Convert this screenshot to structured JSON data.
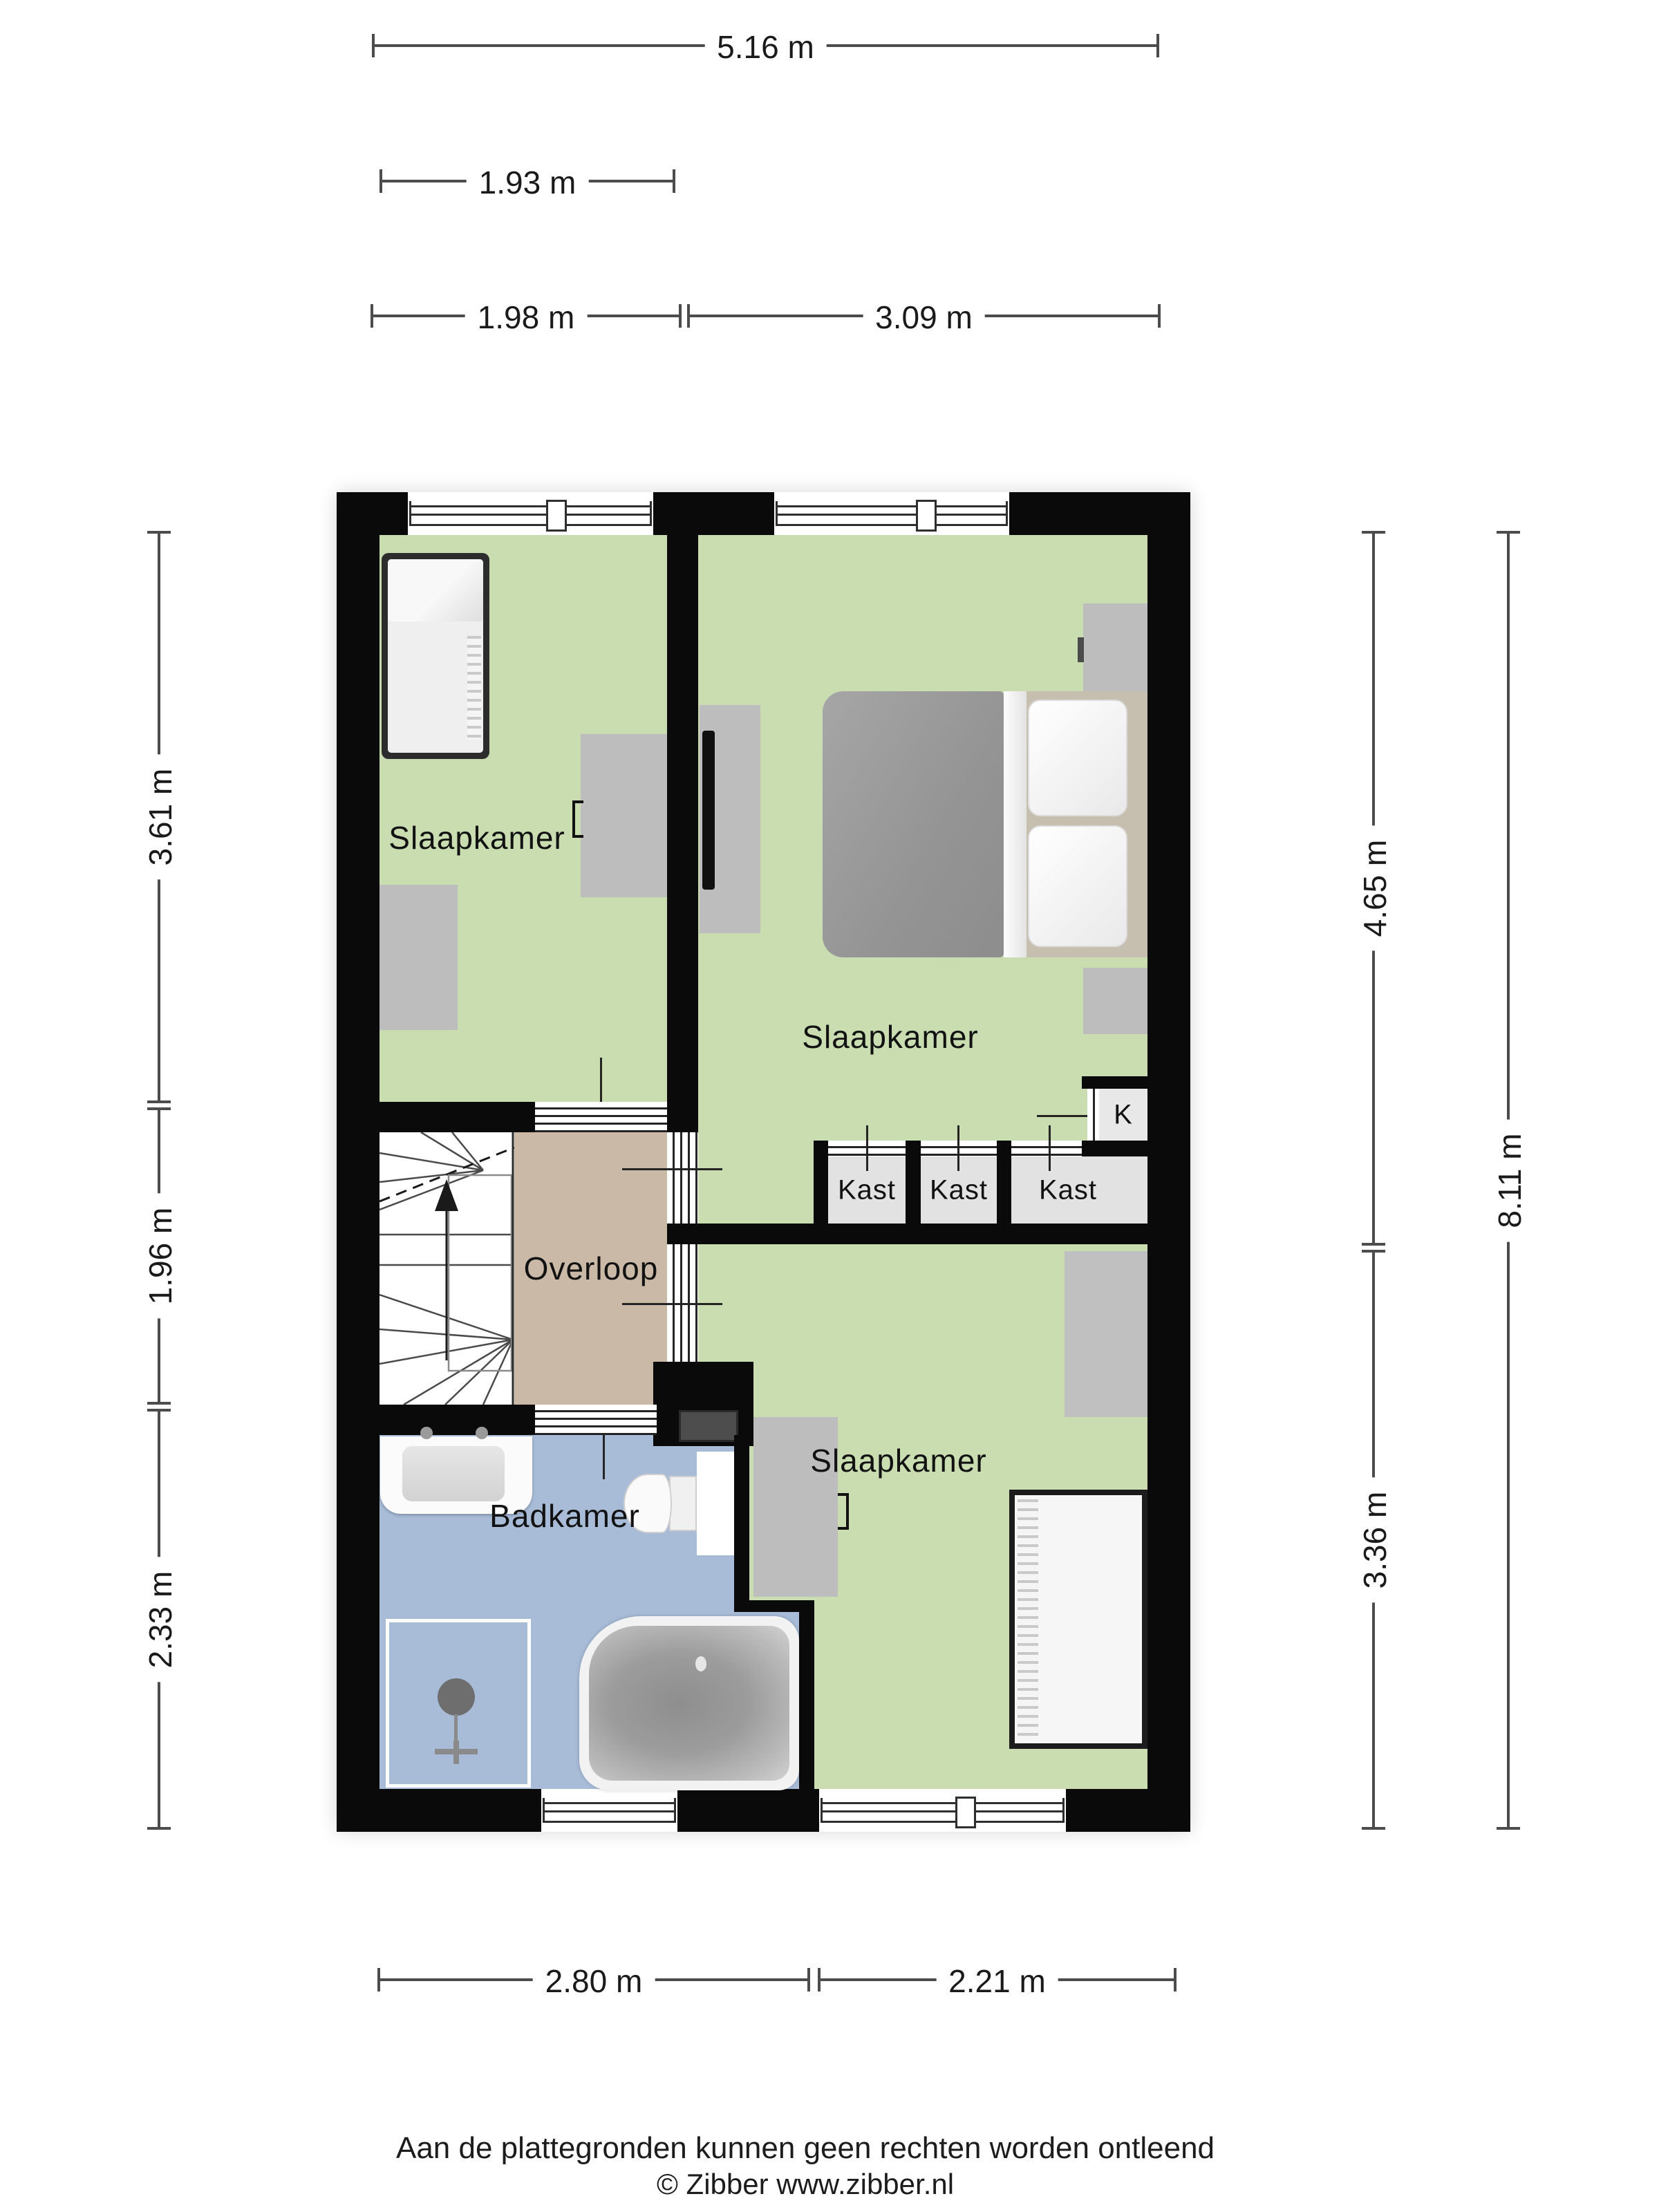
{
  "floorplan": {
    "rooms": [
      {
        "name": "slaapkamer-left",
        "label": "Slaapkamer"
      },
      {
        "name": "slaapkamer-right",
        "label": "Slaapkamer"
      },
      {
        "name": "slaapkamer-bottom",
        "label": "Slaapkamer"
      },
      {
        "name": "overloop",
        "label": "Overloop"
      },
      {
        "name": "badkamer",
        "label": "Badkamer"
      },
      {
        "name": "kast-1",
        "label": "Kast"
      },
      {
        "name": "kast-2",
        "label": "Kast"
      },
      {
        "name": "kast-3",
        "label": "Kast"
      },
      {
        "name": "k-closet",
        "label": "K"
      }
    ],
    "dimensions": {
      "top": [
        {
          "label": "5.16 m"
        },
        {
          "label": "1.93 m"
        },
        {
          "label": "1.98 m"
        },
        {
          "label": "3.09 m"
        }
      ],
      "left": [
        {
          "label": "3.61 m"
        },
        {
          "label": "1.96 m"
        },
        {
          "label": "2.33 m"
        }
      ],
      "right": [
        {
          "label": "4.65 m"
        },
        {
          "label": "3.36 m"
        },
        {
          "label": "8.11 m"
        }
      ],
      "bottom": [
        {
          "label": "2.80 m"
        },
        {
          "label": "2.21 m"
        }
      ]
    },
    "colors": {
      "room_green": "#c9ddb1",
      "hall_tan": "#c9b9a6",
      "bath_blue": "#a8bcd8",
      "closet_floor": "#e2e2e2",
      "furniture_gray": "#bdbdbd",
      "wall_black": "#0a0a0a"
    }
  },
  "footer": {
    "disclaimer": "Aan de plattegronden kunnen geen rechten worden ontleend",
    "copyright": "© Zibber www.zibber.nl"
  }
}
